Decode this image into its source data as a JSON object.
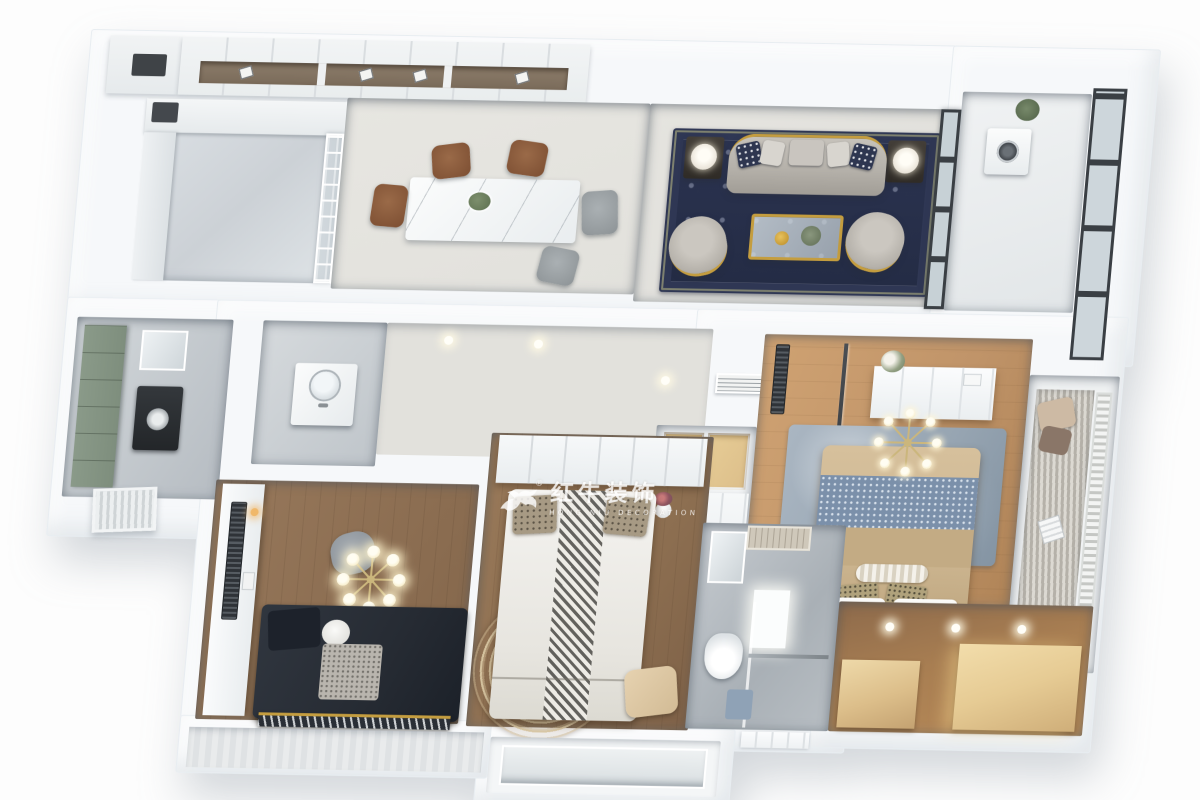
{
  "watermark": {
    "logo_icon": "running-bull-icon",
    "registered_mark": "®",
    "title": "红牛装饰",
    "subtitle": "HONG NIU DECORATION"
  },
  "palette": {
    "bg": "#fdfdfd",
    "wall": "#f6f8fa",
    "wall-edge": "#e8edf1",
    "floor-light": "#e2e1dc",
    "floor-living": "#dfdeda",
    "marble": "#ccd1d6",
    "marble-dark": "#b6bcc2",
    "wood-study": "#8a6c50",
    "wood-bed2": "#8d6f51",
    "wood-master": "#c09469",
    "wood-closet": "#a87e52",
    "wood-cabinet": "#dcbe8a",
    "navy-rug": "#2b3350",
    "gold": "#c49d3f",
    "sofa-gray": "#b5b1aa",
    "sage-green": "#7e8e7d",
    "rug-blue": "#97a5b2",
    "runner-blue": "#7b90aa",
    "bed-tan": "#cdb691",
    "bed-dark": "#262b33",
    "glass": "#c7d1d6",
    "frame-dark": "#3a3f44",
    "shelf-brown": "#8c7c6a"
  }
}
